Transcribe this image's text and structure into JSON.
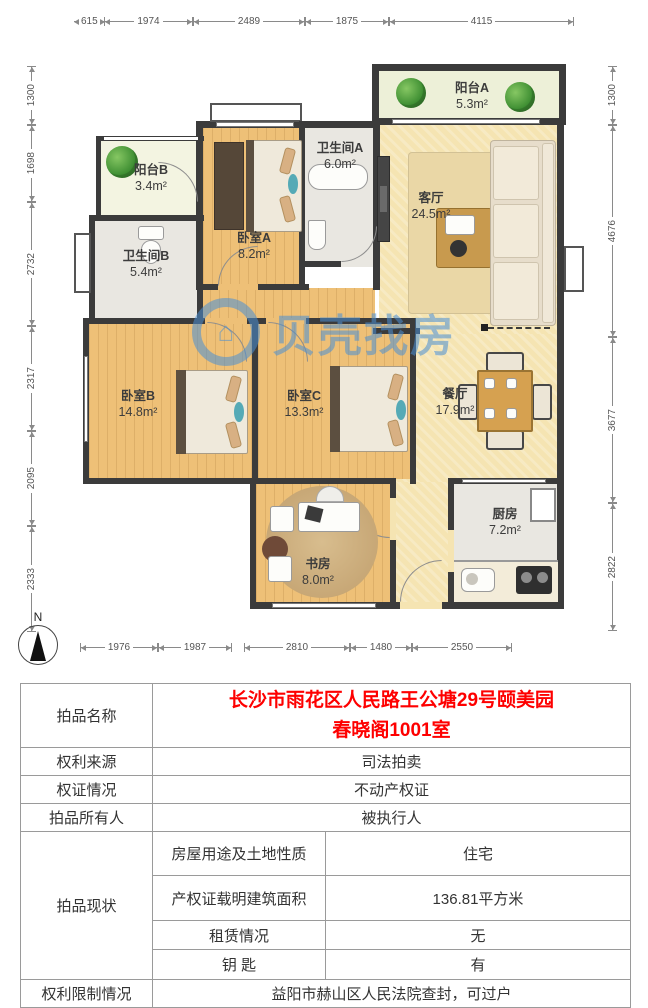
{
  "floorplan": {
    "watermark_text": "贝壳找房",
    "compass_label": "N",
    "rooms": {
      "balcony_a": {
        "name": "阳台A",
        "area": "5.3m²"
      },
      "balcony_b": {
        "name": "阳台B",
        "area": "3.4m²"
      },
      "living": {
        "name": "客厅",
        "area": "24.5m²"
      },
      "bath_a": {
        "name": "卫生间A",
        "area": "6.0m²"
      },
      "bath_b": {
        "name": "卫生间B",
        "area": "5.4m²"
      },
      "bedroom_a": {
        "name": "卧室A",
        "area": "8.2m²"
      },
      "bedroom_b": {
        "name": "卧室B",
        "area": "14.8m²"
      },
      "bedroom_c": {
        "name": "卧室C",
        "area": "13.3m²"
      },
      "dining": {
        "name": "餐厅",
        "area": "17.9m²"
      },
      "study": {
        "name": "书房",
        "area": "8.0m²"
      },
      "kitchen": {
        "name": "厨房",
        "area": "7.2m²"
      }
    },
    "dims": {
      "top": [
        "615",
        "1974",
        "2489",
        "1875",
        "4115"
      ],
      "left": [
        "1300",
        "1698",
        "2732",
        "2317",
        "2095",
        "2333"
      ],
      "right": [
        "1300",
        "4676",
        "3677",
        "2822"
      ],
      "bottom": [
        "1976",
        "1987",
        "2810",
        "1480",
        "2550"
      ]
    }
  },
  "info_table": {
    "rows": {
      "name": {
        "label": "拍品名称",
        "value": "长沙市雨花区人民路王公塘29号颐美园春晓阁1001室"
      },
      "source": {
        "label": "权利来源",
        "value": "司法拍卖"
      },
      "cert": {
        "label": "权证情况",
        "value": "不动产权证"
      },
      "owner": {
        "label": "拍品所有人",
        "value": "被执行人"
      },
      "status": {
        "label": "拍品现状",
        "sub": [
          {
            "label": "房屋用途及土地性质",
            "value": "住宅"
          },
          {
            "label": "产权证载明建筑面积",
            "value": "136.81平方米"
          },
          {
            "label": "租赁情况",
            "value": "无"
          },
          {
            "label": "钥 匙",
            "value": "有"
          }
        ]
      },
      "restriction": {
        "label": "权利限制情况",
        "value": "益阳市赫山区人民法院查封，可过户"
      }
    },
    "colors": {
      "red_text": "#fe0000",
      "watermark_blue": "#4a8fd4"
    }
  }
}
